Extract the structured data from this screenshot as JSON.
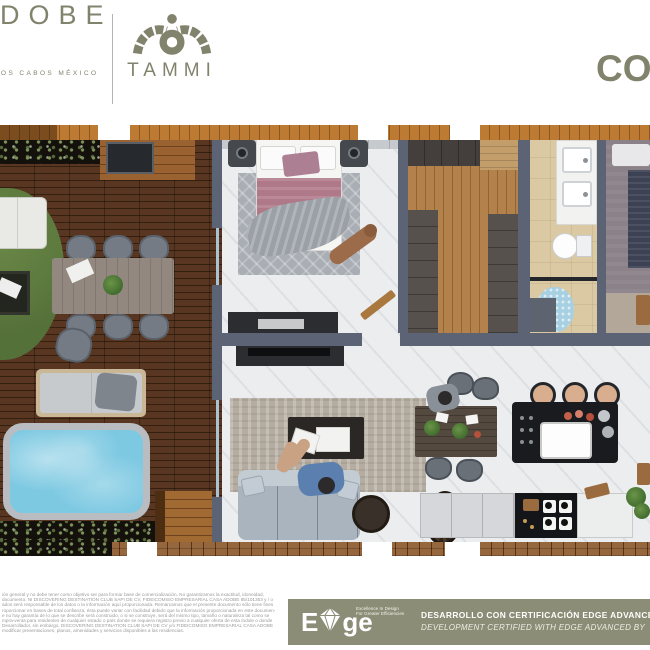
{
  "header": {
    "brand_left": {
      "name_fragment": "DOBE",
      "subtitle_fragment": "OS CABOS MÉXICO"
    },
    "brand_center": {
      "logo_word": "TAMMI"
    },
    "brand_right_fragment": "CO"
  },
  "footer": {
    "disclaimer_lines": [
      "ión general y no debe tener como objetivo ser para formar base de comercialización. No garantizamos la exactitud, idoneidad,",
      "documento. NI DISCOVERING DESTINATION CLUB SAPI DE CV, FIDEICOMISO EMPRESARIAL CASA ADOBE 85/101353 y / o",
      "ados será responsable de los datos o la información aquí proporcionada. Remarcamos que el presente documento sólo tiene fines",
      "roporcionar en bases de total confianza, ésta puede variar con facilidad debido que la información proporcionada en este documen-",
      "e no hay garantía de lo que se describe será construido, o si se construye, será del mismo tipo, tamaño o naturaleza tal como se",
      "mpra-venta para residentes de cualquier estado o país donde se requiera registro previo a cualquier oferta de esta índole o donde",
      "Desarrollador, sin embargo, DISCOVERING DESTINATION CLUB SAPI DE CV y/o FIDEICOMISO EMPRESARIAL CASA ADOBE",
      "modificar presentaciones, planos, amenidades y servicios disponibles a las residencias."
    ],
    "edge": {
      "logo_e": "E",
      "logo_ge": "ge",
      "tagline_line1": "Excellence In Design",
      "tagline_line2": "For Greater Efficiencies",
      "headline_es": "DESARROLLO CON CERTIFICACIÓN EDGE ADVANCED",
      "headline_en": "DEVELOPMENT CERTIFIED WITH EDGE ADVANCED BY"
    }
  },
  "colors": {
    "brand_olive": "#81836c",
    "band_bg": "#8b8d77",
    "wall": "#5b6375",
    "pool_water": "#7ec9e2",
    "pool_coping": "#b9bdc1",
    "bed_mauve": "#b0798a",
    "sofa_gray": "#aab4bf",
    "disclaimer_text": "#9b9b9b"
  }
}
